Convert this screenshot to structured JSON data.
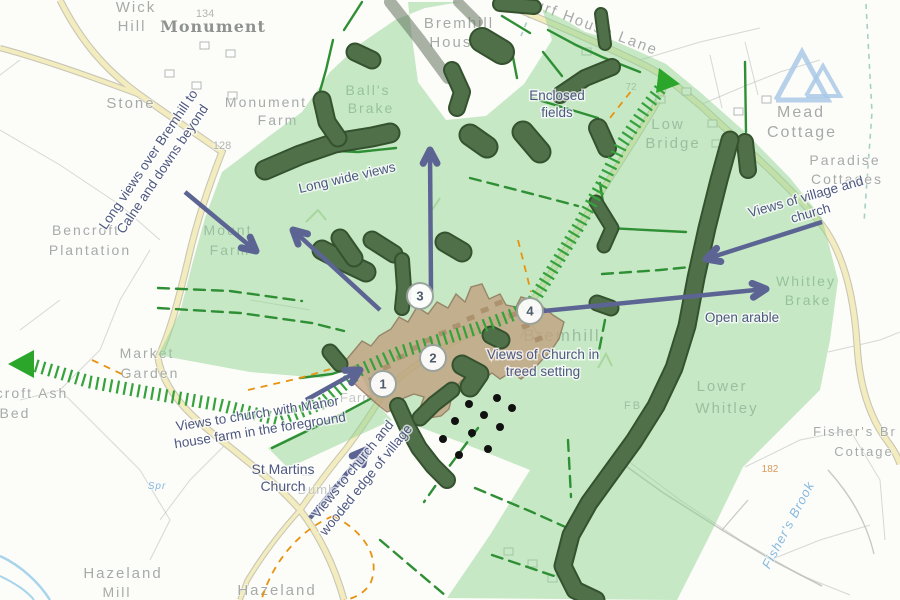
{
  "map": {
    "title": "Bremhill village landscape views map",
    "colors": {
      "study_area_green": "#8fd492",
      "tree_dark": "#4f7049",
      "tree_outline": "#35522f",
      "tree_translucent": "#63725f",
      "field_line_green": "#2f8f35",
      "route_hatch_green": "#35a23c",
      "route_arrowhead_green": "#2ba62b",
      "view_arrow_slate": "#5c6493",
      "village_fill": "#c2a07f",
      "village_outline": "#8a6a50",
      "building_fill": "#9c7a58",
      "road_fill": "#f3ecbe",
      "road_casing": "#c9c6b4",
      "boundary_orange": "#e8930f",
      "water_blue": "#a8d4ec",
      "campsite_blue": "#a9c9e6",
      "annotation_text": "#4d5880",
      "base_label_gray": "#a6aba6",
      "orchard_dot": "#111111"
    },
    "base_labels": [
      {
        "t": "Wick",
        "x": 136,
        "y": 12,
        "s": 15,
        "c": "place"
      },
      {
        "t": "Hill",
        "x": 132,
        "y": 31,
        "s": 15,
        "c": "place"
      },
      {
        "t": "Monument",
        "x": 213,
        "y": 32,
        "s": 16,
        "c": "black"
      },
      {
        "t": "134",
        "x": 205,
        "y": 17,
        "s": 11,
        "c": "contour"
      },
      {
        "t": "Stone",
        "x": 131,
        "y": 108,
        "s": 15,
        "c": "place"
      },
      {
        "t": "Monument",
        "x": 266,
        "y": 107,
        "s": 14,
        "c": "place"
      },
      {
        "t": "Farm",
        "x": 278,
        "y": 125,
        "s": 14,
        "c": "place"
      },
      {
        "t": "128",
        "x": 222,
        "y": 149,
        "s": 11,
        "c": "contour"
      },
      {
        "t": "Bremhill",
        "x": 459,
        "y": 28,
        "s": 15,
        "c": "place"
      },
      {
        "t": "House",
        "x": 456,
        "y": 47,
        "s": 15,
        "c": "place"
      },
      {
        "t": "Turf House Lane",
        "x": 590,
        "y": 30,
        "s": 15,
        "c": "place",
        "r": 21
      },
      {
        "t": "72",
        "x": 631,
        "y": 90,
        "s": 10,
        "c": "contour"
      },
      {
        "t": "Low",
        "x": 668,
        "y": 129,
        "s": 15,
        "c": "place"
      },
      {
        "t": "Bridge",
        "x": 673,
        "y": 148,
        "s": 15,
        "c": "place"
      },
      {
        "t": "Mead",
        "x": 801,
        "y": 117,
        "s": 16,
        "c": "place"
      },
      {
        "t": "Cottage",
        "x": 802,
        "y": 137,
        "s": 16,
        "c": "place"
      },
      {
        "t": "Paradise",
        "x": 845,
        "y": 165,
        "s": 14,
        "c": "place"
      },
      {
        "t": "Cottages",
        "x": 847,
        "y": 184,
        "s": 14,
        "c": "place"
      },
      {
        "t": "Ball's",
        "x": 368,
        "y": 95,
        "s": 14,
        "c": "wood"
      },
      {
        "t": "Brake",
        "x": 371,
        "y": 113,
        "s": 14,
        "c": "wood"
      },
      {
        "t": "Bencroft",
        "x": 86,
        "y": 235,
        "s": 14,
        "c": "place"
      },
      {
        "t": "Plantation",
        "x": 90,
        "y": 255,
        "s": 14,
        "c": "place"
      },
      {
        "t": "Mount",
        "x": 228,
        "y": 235,
        "s": 14,
        "c": "place"
      },
      {
        "t": "Farm",
        "x": 230,
        "y": 255,
        "s": 14,
        "c": "place"
      },
      {
        "t": "Market",
        "x": 147,
        "y": 358,
        "s": 14,
        "c": "place"
      },
      {
        "t": "Garden",
        "x": 150,
        "y": 378,
        "s": 14,
        "c": "place"
      },
      {
        "t": "croft Ash",
        "x": 32,
        "y": 398,
        "s": 14,
        "c": "place"
      },
      {
        "t": "Bed",
        "x": 15,
        "y": 418,
        "s": 14,
        "c": "place"
      },
      {
        "t": "Whitley",
        "x": 806,
        "y": 286,
        "s": 14,
        "c": "wood"
      },
      {
        "t": "Brake",
        "x": 808,
        "y": 305,
        "s": 14,
        "c": "wood"
      },
      {
        "t": "Lower",
        "x": 722,
        "y": 391,
        "s": 15,
        "c": "place"
      },
      {
        "t": "Whitley",
        "x": 727,
        "y": 413,
        "s": 15,
        "c": "place"
      },
      {
        "t": "FB",
        "x": 633,
        "y": 409,
        "s": 11,
        "c": "place"
      },
      {
        "t": "Bremhill",
        "x": 562,
        "y": 341,
        "s": 17,
        "c": "place"
      },
      {
        "t": "Fisher's Br",
        "x": 855,
        "y": 436,
        "s": 13,
        "c": "place"
      },
      {
        "t": "Cottage",
        "x": 864,
        "y": 456,
        "s": 13,
        "c": "place"
      },
      {
        "t": "182",
        "x": 770,
        "y": 472,
        "s": 10,
        "c": "orange"
      },
      {
        "t": "Fisher's Brook",
        "x": 792,
        "y": 527,
        "s": 13,
        "c": "water",
        "r": -62
      },
      {
        "t": "Hazeland",
        "x": 123,
        "y": 578,
        "s": 15,
        "c": "place"
      },
      {
        "t": "Mill",
        "x": 117,
        "y": 597,
        "s": 14,
        "c": "place"
      },
      {
        "t": "Hazeland",
        "x": 277,
        "y": 595,
        "s": 15,
        "c": "place"
      },
      {
        "t": "Spr",
        "x": 157,
        "y": 489,
        "s": 10,
        "c": "water"
      },
      {
        "t": "Farm",
        "x": 357,
        "y": 402,
        "s": 13,
        "c": "faint"
      },
      {
        "t": "Dumb",
        "x": 317,
        "y": 494,
        "s": 13,
        "c": "faint"
      }
    ],
    "annotations": [
      {
        "n": "long-views-over-bremhill",
        "lines": [
          "Long views over Bremhill to",
          "Calne and downs beyond"
        ],
        "x": 152,
        "y": 162,
        "r": -56,
        "s": 13.5
      },
      {
        "n": "long-wide-views",
        "lines": [
          "Long wide views"
        ],
        "x": 348,
        "y": 182,
        "r": -13,
        "s": 13.5
      },
      {
        "n": "enclosed-fields",
        "lines": [
          "Enclosed",
          "fields"
        ],
        "x": 557,
        "y": 100,
        "r": 0,
        "s": 13.5
      },
      {
        "n": "views-of-village-and-church",
        "lines": [
          "Views of village and",
          "church"
        ],
        "x": 807,
        "y": 201,
        "r": -16,
        "s": 13.5
      },
      {
        "n": "open-arable",
        "lines": [
          "Open arable"
        ],
        "x": 742,
        "y": 322,
        "r": 0,
        "s": 13.5
      },
      {
        "n": "views-of-church-in-treed-setting",
        "lines": [
          "Views of Church in",
          "treed setting"
        ],
        "x": 543,
        "y": 359,
        "r": 0,
        "s": 13.5
      },
      {
        "n": "views-to-church-with-manor-house-farm",
        "lines": [
          "Views to church with Manor",
          "house farm in the foreground"
        ],
        "x": 258,
        "y": 418,
        "r": -9,
        "s": 13.5
      },
      {
        "n": "views-to-church-and-wooded-edge",
        "lines": [
          "Views to church and",
          "wooded edge of village"
        ],
        "x": 356,
        "y": 472,
        "r": -51,
        "s": 13.5
      },
      {
        "n": "st-martins-church",
        "lines": [
          "St Martins",
          "Church"
        ],
        "x": 283,
        "y": 474,
        "r": 0,
        "s": 14
      }
    ],
    "markers": [
      {
        "label": "1",
        "x": 383,
        "y": 384
      },
      {
        "label": "2",
        "x": 433,
        "y": 358
      },
      {
        "label": "3",
        "x": 420,
        "y": 296
      },
      {
        "label": "4",
        "x": 530,
        "y": 311
      }
    ],
    "arrows": [
      {
        "n": "view-arrow-long-views-southeast",
        "x1": 185,
        "y1": 192,
        "x2": 256,
        "y2": 251
      },
      {
        "n": "view-arrow-long-wide-views-northwest",
        "x1": 380,
        "y1": 310,
        "x2": 293,
        "y2": 230
      },
      {
        "n": "view-arrow-long-wide-views-north",
        "x1": 431,
        "y1": 292,
        "x2": 430,
        "y2": 150
      },
      {
        "n": "view-arrow-views-to-church-manor-farm",
        "x1": 306,
        "y1": 400,
        "x2": 360,
        "y2": 370
      },
      {
        "n": "view-arrow-views-to-church-wooded-edge",
        "x1": 310,
        "y1": 518,
        "x2": 366,
        "y2": 450
      },
      {
        "n": "view-arrow-open-arable-east",
        "x1": 533,
        "y1": 312,
        "x2": 766,
        "y2": 289
      },
      {
        "n": "view-arrow-views-of-village-southwest",
        "x1": 822,
        "y1": 222,
        "x2": 706,
        "y2": 259
      }
    ],
    "icons": [
      {
        "name": "route-arrowhead-west-icon",
        "x": 20,
        "y": 364
      },
      {
        "name": "route-arrowhead-northeast-icon",
        "x": 667,
        "y": 81
      },
      {
        "name": "campsite-icon",
        "x": 804,
        "y": 76
      }
    ]
  }
}
